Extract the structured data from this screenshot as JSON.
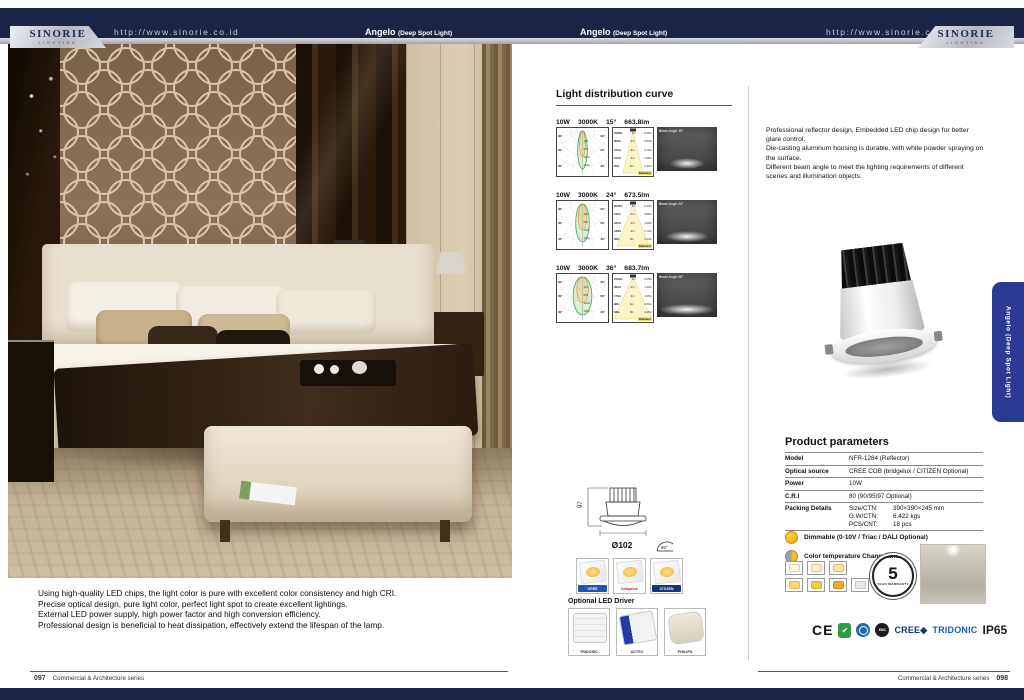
{
  "brand": {
    "name": "SINORIE",
    "tagline": "LIGHTING",
    "url": "http://www.sinorie.co.id"
  },
  "product": {
    "name": "Angelo",
    "type": "(Deep Spot Light)"
  },
  "left_page": {
    "description_lines": [
      "Using high-quality LED chips, the light color is pure with excellent color consistency and high CRI.",
      "Precise optical design, pure light color, perfect light spot to create excellent lightings.",
      "External LED power supply, high power factor and high conversion efficiency.",
      "Professional design is beneficial to heat dissipation, effectively extend the lifespan of the lamp."
    ],
    "footer": {
      "page": "097",
      "series": "Commercial & Architecture series"
    }
  },
  "right_page": {
    "curve_section": {
      "title": "Light distribution curve",
      "polar_side": [
        "90°",
        "60°",
        "30°"
      ],
      "polar_scale": [
        "400",
        "800",
        "1200",
        "1600"
      ],
      "cone_footer": "Diameter",
      "rows": [
        {
          "power": "10W",
          "cct": "3000K",
          "angle": "15°",
          "angle_value": 15,
          "lumens": "663.8lm",
          "beam_label": "Beam Angle 15°",
          "cone_rows": [
            [
              "2435lx",
              "1m",
              "0.26m"
            ],
            [
              "609lx",
              "2m",
              "0.53m"
            ],
            [
              "271lx",
              "3m",
              "0.79m"
            ],
            [
              "152lx",
              "4m",
              "1.05m"
            ],
            [
              "97lx",
              "5m",
              "1.32m"
            ]
          ]
        },
        {
          "power": "10W",
          "cct": "3000K",
          "angle": "24°",
          "angle_value": 24,
          "lumens": "673.5lm",
          "beam_label": "Beam Angle 24°",
          "cone_rows": [
            [
              "2045lx",
              "1m",
              "0.43m"
            ],
            [
              "511lx",
              "2m",
              "0.85m"
            ],
            [
              "227lx",
              "3m",
              "1.28m"
            ],
            [
              "128lx",
              "4m",
              "1.70m"
            ],
            [
              "82lx",
              "5m",
              "2.13m"
            ]
          ]
        },
        {
          "power": "10W",
          "cct": "3000K",
          "angle": "36°",
          "angle_value": 36,
          "lumens": "683.7lm",
          "beam_label": "Beam Angle 36°",
          "cone_rows": [
            [
              "1564lx",
              "1m",
              "0.65m"
            ],
            [
              "391lx",
              "2m",
              "1.30m"
            ],
            [
              "174lx",
              "3m",
              "1.95m"
            ],
            [
              "98lx",
              "4m",
              "2.60m"
            ],
            [
              "63lx",
              "5m",
              "3.25m"
            ]
          ]
        }
      ]
    },
    "intro_lines": [
      "Professional reflector design, Embedded LED chip design for better glare control.",
      "Die-casting aluminum housing is durable, with white powder spraying on the surface.",
      "Different beam angle to meet the lighting requirements of different scenes and illumination objects."
    ],
    "params": {
      "title": "Product parameters",
      "rows": [
        {
          "label": "Model",
          "value": "NFR-1284  (Reflector)"
        },
        {
          "label": "Optical source",
          "value": "CREE COB (bridgelux / CITIZEN Optional)"
        },
        {
          "label": "Power",
          "value": "10W"
        },
        {
          "label": "C.R.I",
          "value": "80 (90/95/97 Optional)"
        }
      ],
      "packing": {
        "label": "Packing Details",
        "lines": [
          [
            "Size/CTN:",
            "390×390×245 mm"
          ],
          [
            "G.W/CTN:",
            "6.422 kgs"
          ],
          [
            "PCS/CNT:",
            "18 pcs"
          ]
        ]
      }
    },
    "features": [
      {
        "label": "Dimmable (0-10V / Triac / DALI Optional)"
      },
      {
        "label": "Color temperature Changeable"
      }
    ],
    "swatches": {
      "top": [
        "#fff6e0",
        "#ffedc0",
        "#ffe39a"
      ],
      "bottom": [
        "#ffd76e",
        "#ffc84a",
        "#f5a623",
        "#e8e8e8"
      ]
    },
    "warranty": {
      "number": "5",
      "label": "YEAR WARRANTY"
    },
    "dimensions": {
      "height": "97",
      "diameter": "Ø102",
      "tilt": "80°"
    },
    "led_chips": [
      {
        "name": "CREE",
        "bg": "#1f57b0",
        "fg": "#ffffff"
      },
      {
        "name": "bridgelux",
        "bg": "#ffffff",
        "fg": "#c8102e"
      },
      {
        "name": "CITIZEN",
        "bg": "#15357a",
        "fg": "#ffffff"
      }
    ],
    "drivers": {
      "title": "Optional LED Driver",
      "items": [
        "TRIDONIC",
        "ACTEC",
        "PHILIPS"
      ]
    },
    "certs": {
      "ce": "CE",
      "green_check": "✔",
      "emc": "EMC",
      "cree": "CREE◆",
      "tridonic": "TRIDONIC",
      "ip": "IP65"
    },
    "side_tab": "Angelo (Deep Spot Light)",
    "footer": {
      "series": "Commercial & Architecture series",
      "page": "098"
    }
  }
}
